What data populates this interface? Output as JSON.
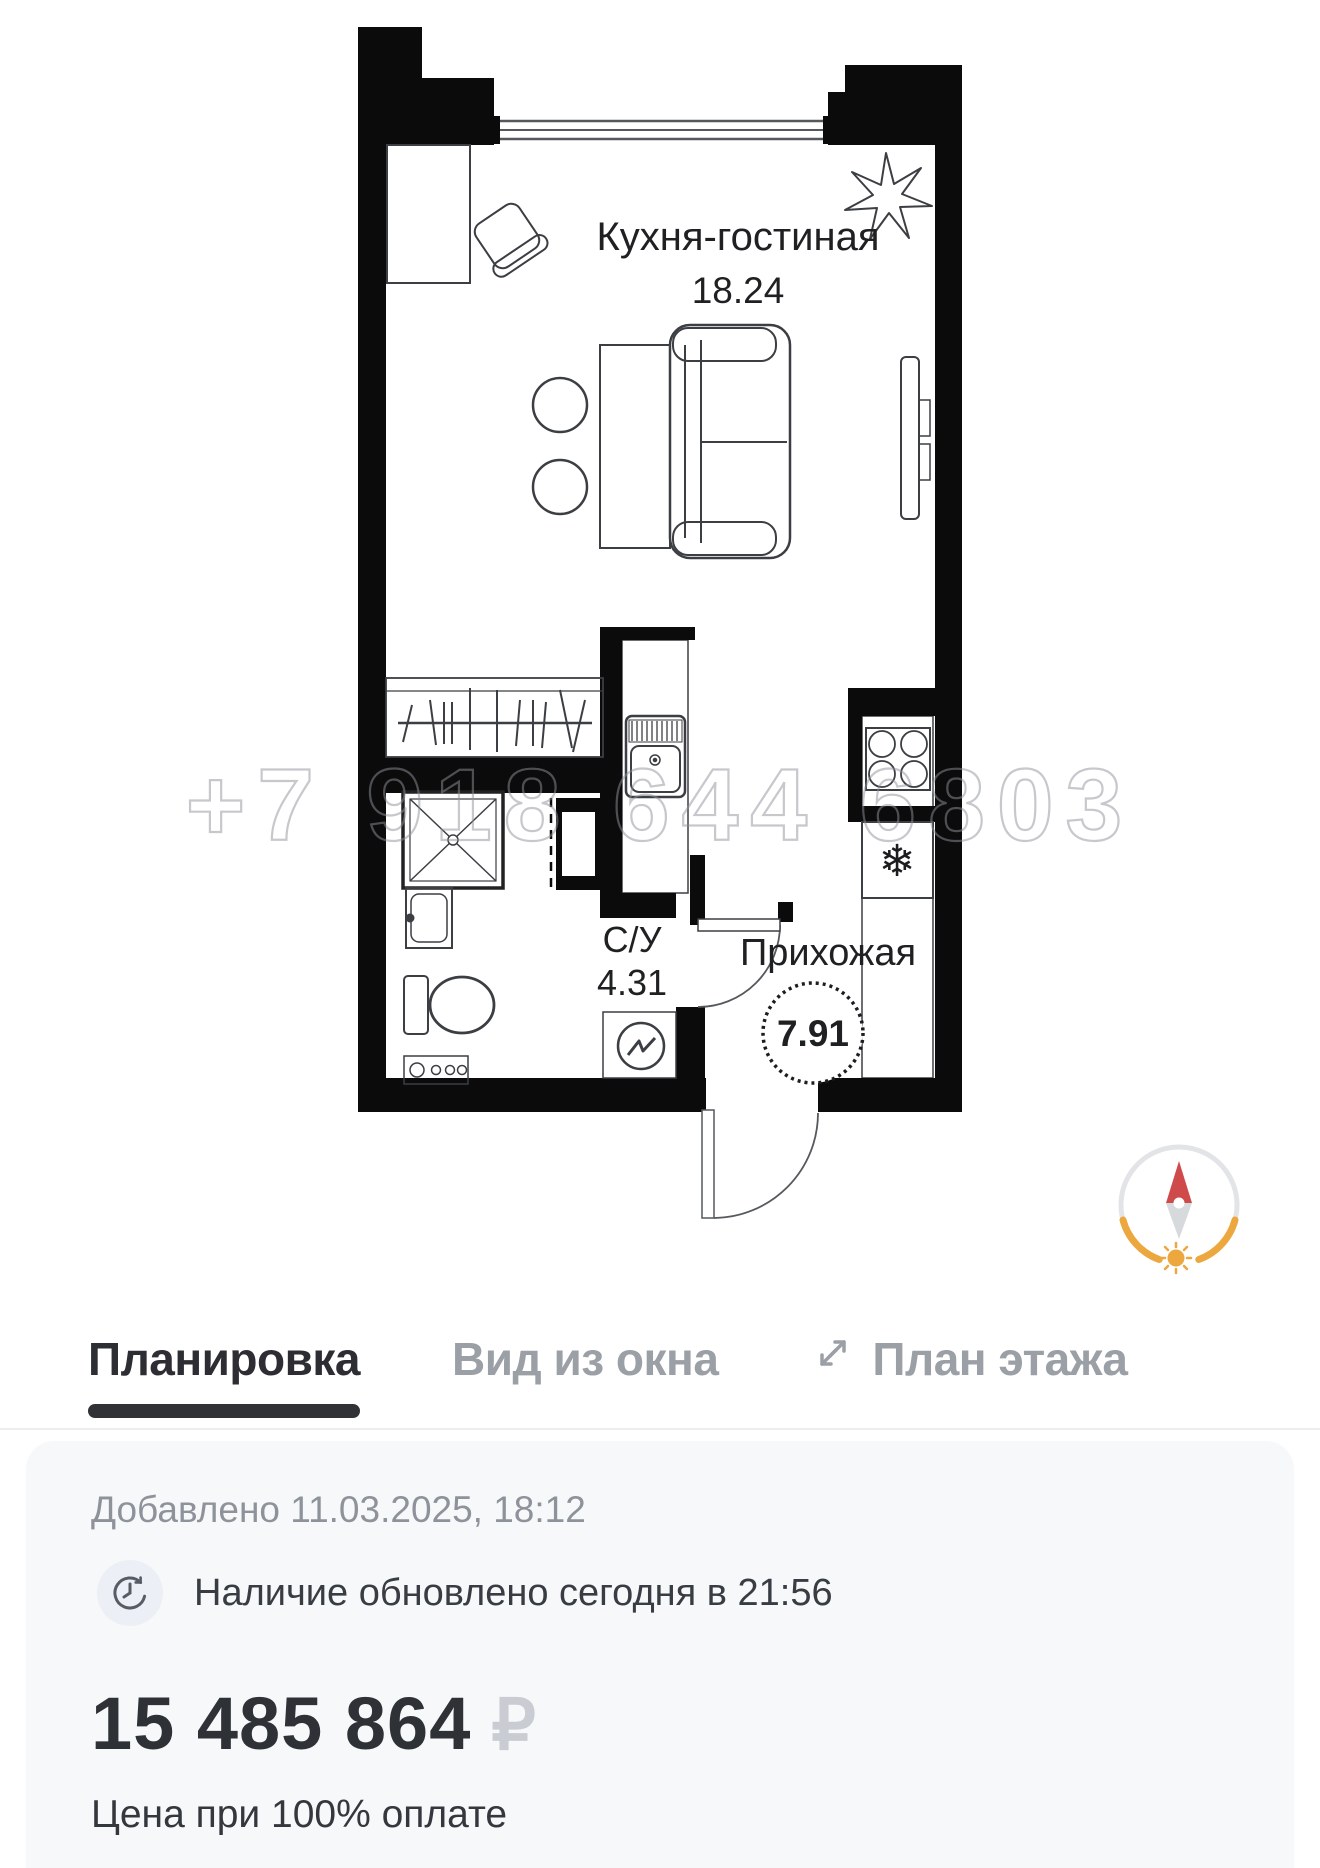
{
  "floor_plan": {
    "watermark": "+7 918 644 6803",
    "rooms": [
      {
        "name": "Кухня-гостиная",
        "area": "18.24"
      },
      {
        "name": "С/У",
        "area": "4.31"
      },
      {
        "name": "Прихожая",
        "area": "7.91"
      }
    ],
    "icons": {
      "snowflake": "❄"
    }
  },
  "tabs": [
    {
      "label": "Планировка",
      "active": true
    },
    {
      "label": "Вид из окна",
      "active": false
    },
    {
      "label": "План этажа",
      "active": false
    }
  ],
  "info": {
    "added": "Добавлено 11.03.2025, 18:12",
    "availability": "Наличие обновлено сегодня в 21:56",
    "price": "15 485 864",
    "currency": "₽",
    "price_note": "Цена при 100% оплате"
  },
  "colors": {
    "wall": "#0b0b0b",
    "furniture_line": "#3b3e42",
    "tab_active": "#2c2e33",
    "tab_inactive": "#9b9fa6",
    "compass_red": "#cf4b4b",
    "compass_orange": "#eca73f",
    "watermark_gray": "#8e939b"
  }
}
